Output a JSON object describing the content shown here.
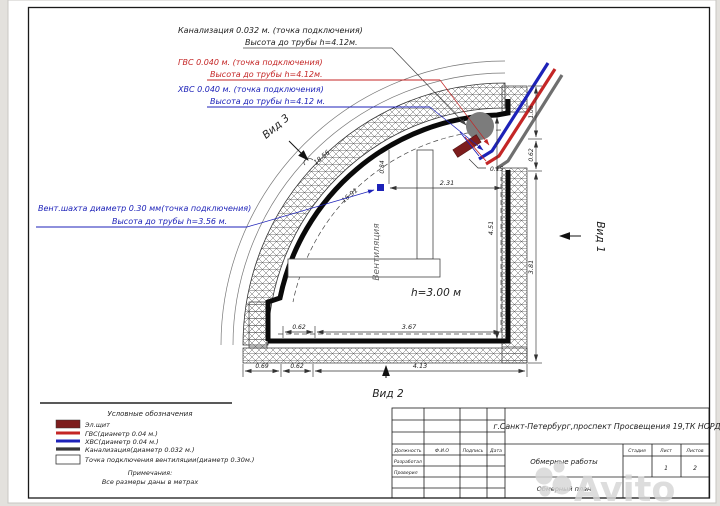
{
  "annotations": {
    "sewer": {
      "l1": "Канализация 0.032 м. (точка подключения)",
      "l2": "Высота до трубы h=4.12м."
    },
    "hot_water": {
      "l1": "ГВС 0.040 м. (точка подключения)",
      "l2": "Высота до трубы h=4.12м."
    },
    "cold_water": {
      "l1": "ХВС 0.040 м. (точка подключения)",
      "l2": "Высота до трубы h=4.12 м."
    },
    "vent": {
      "l1": "Вент.шахта диаметр 0.30 мм(точка подключения)",
      "l2": "Высота до трубы h=3.56 м."
    }
  },
  "views": {
    "v1": "Вид 1",
    "v2": "Вид 2",
    "v3": "Вид 3"
  },
  "room": {
    "height": "h=3.00 м",
    "vent_shaft": "Вентиляция"
  },
  "dims": {
    "d231": "2.31",
    "d451": "4.51",
    "d084": "0.84",
    "d015": "0.15",
    "d106": "1.06",
    "d062": "0.62",
    "d381": "3.81",
    "d367": "3.67",
    "d069": "0.69",
    "d413": "4.13",
    "arc_outer": "18.56",
    "arc_inner": "16.91"
  },
  "legend": {
    "title": "Условные обозначения",
    "items": [
      {
        "label": "Эл.щит"
      },
      {
        "label": "ГВС(диаметр 0.04 м.)"
      },
      {
        "label": "ХВС(диаметр 0.04 м.)"
      },
      {
        "label": "Канализация(диаметр 0.032 м.)"
      },
      {
        "label": "Точка подключения вентиляции(диаметр 0.30м.)"
      }
    ],
    "notes_title": "Примечания:",
    "notes": "Все размеры даны в метрах"
  },
  "titleblock": {
    "address": "г.Санкт-Петербург,проспект Просвещения 19,ТК НОРД",
    "work_type": "Обмерные работы",
    "drawing_name": "Обмерный план",
    "col_position": "Должность",
    "col_name": "Ф.И.О",
    "col_sign": "Подпись",
    "col_date": "Дата",
    "row_developed": "Разработал",
    "row_checked": "Проверил",
    "stage_label": "Стадия",
    "sheet_label": "Лист",
    "sheets_label": "Листов",
    "sheet_value": "1",
    "sheets_value": "2"
  },
  "watermark": {
    "text": "Avito"
  },
  "colors": {
    "hot_water": "#c42626",
    "cold_water": "#1d22b8",
    "sewer_pipe": "#6f6f6f",
    "panel": "#7d1d1d",
    "boiler": "#7c7c7c"
  }
}
